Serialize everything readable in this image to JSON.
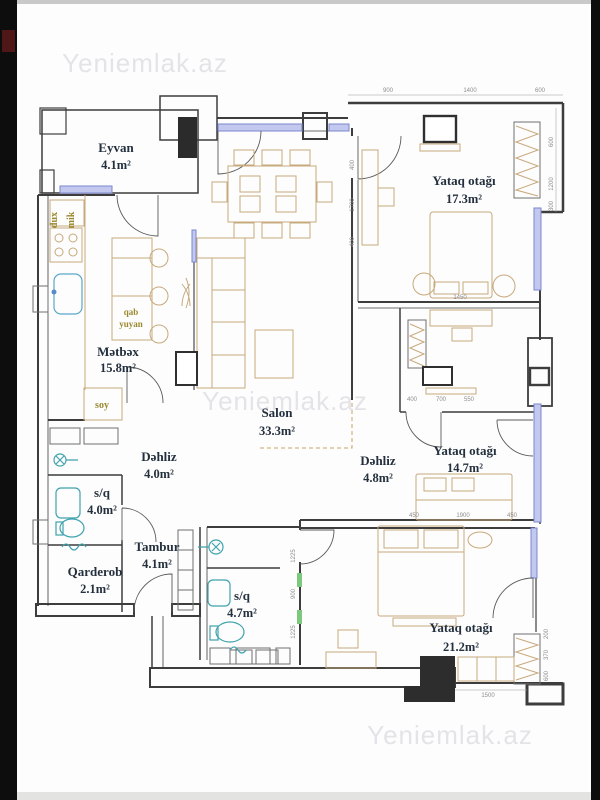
{
  "watermark": {
    "text": "Yeniemlak.az"
  },
  "rooms": [
    {
      "name": "Eyvan",
      "area": "4.1m²"
    },
    {
      "name": "Yataq otağı",
      "area": "17.3m²"
    },
    {
      "name": "Mətbəx",
      "area": "15.8m²"
    },
    {
      "name": "Salon",
      "area": "33.3m²"
    },
    {
      "name": "Dəhliz",
      "area": "4.0m²"
    },
    {
      "name": "s/q",
      "area": "4.0m²"
    },
    {
      "name": "Tambur",
      "area": "4.1m²"
    },
    {
      "name": "Qarderob",
      "area": "2.1m²"
    },
    {
      "name": "s/q",
      "area": "4.7m²"
    },
    {
      "name": "Dəhliz",
      "area": "4.8m²"
    },
    {
      "name": "Yataq otağı",
      "area": "14.7m²"
    },
    {
      "name": "Yataq otağı",
      "area": "21.2m²"
    }
  ],
  "appliance_labels": {
    "dux": "dux",
    "mik": "mik",
    "qab": "qab",
    "yuyan": "yuyan",
    "soy": "soy"
  },
  "dimensions": [
    "900",
    "1400",
    "600",
    "600",
    "1200",
    "300",
    "400",
    "1700",
    "400",
    "1450",
    "400",
    "700",
    "550",
    "450",
    "1900",
    "450",
    "1225",
    "900",
    "1225",
    "1500",
    "200",
    "370",
    "600"
  ],
  "colors": {
    "wall": "#3d3d3d",
    "window_stroke": "#7b85d0",
    "window_fill": "#c3c9ee",
    "furniture": "#c7a97b",
    "fixture": "#3fa3ad",
    "room_label": "#24303e",
    "appliance_label": "#99882e",
    "watermark": "#e4e4e8",
    "door_accent": "#7cc87c"
  }
}
